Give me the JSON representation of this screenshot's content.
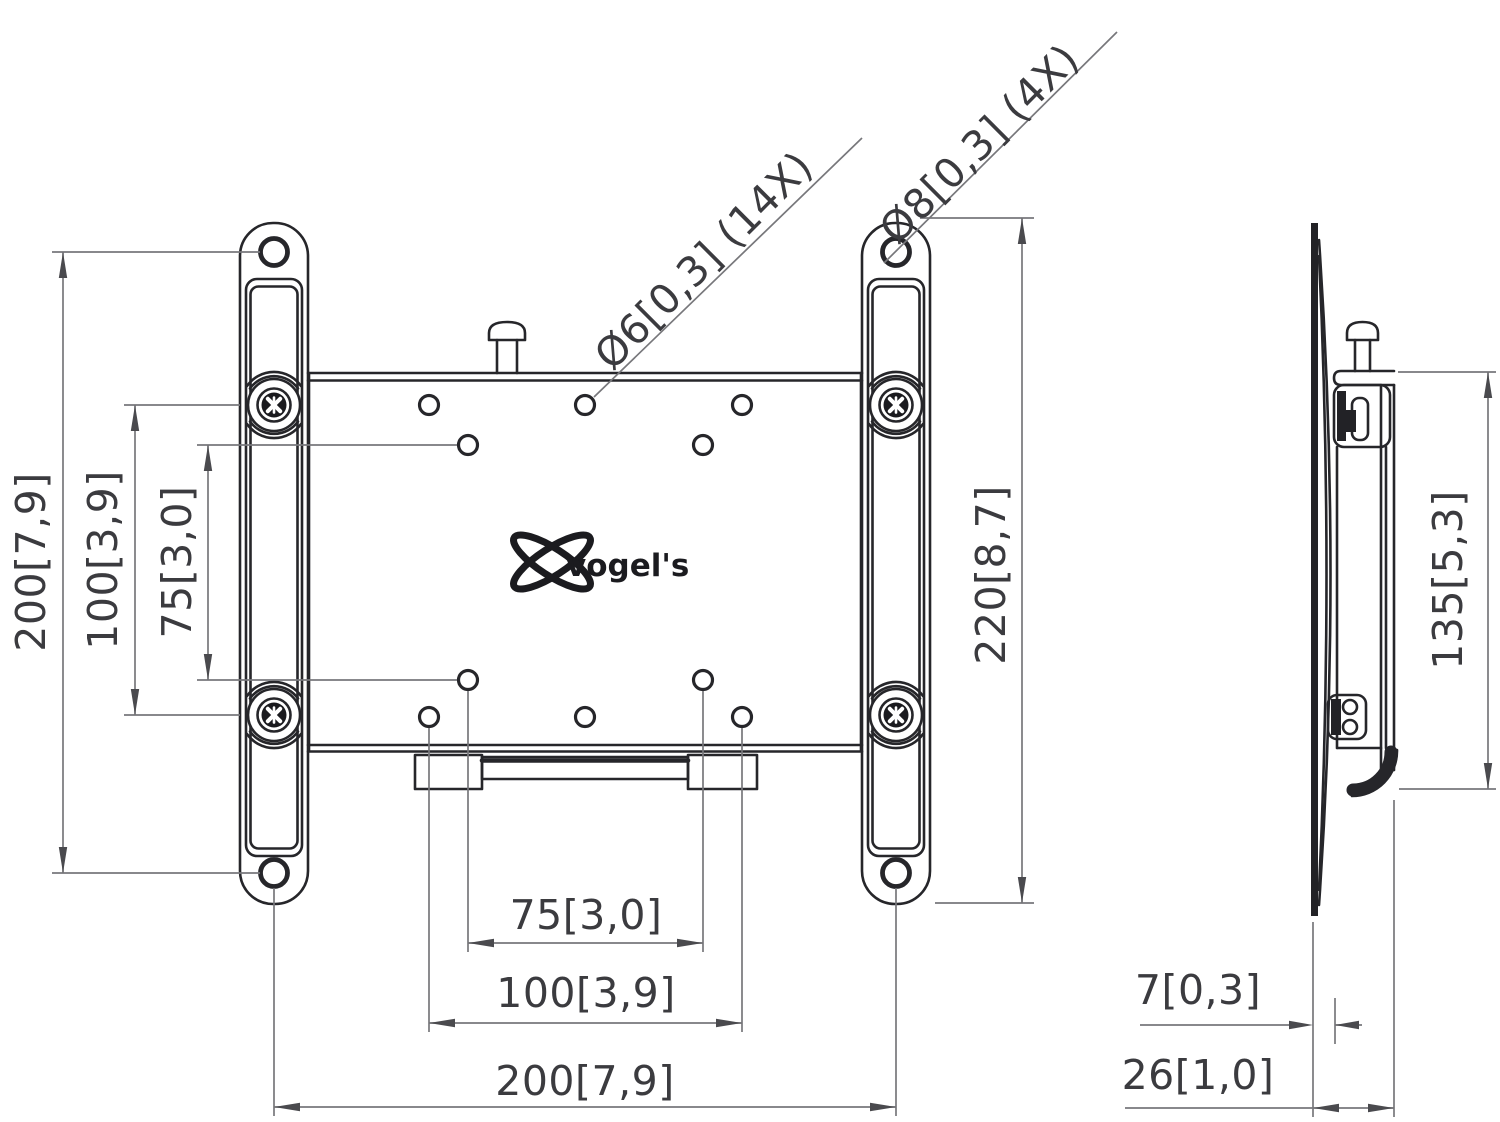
{
  "drawing_type": "technical-dimension-drawing",
  "product": "TV wall mount bracket",
  "views": {
    "front": {
      "dims": {
        "left_outer": "200[7,9]",
        "left_mid": "100[3,9]",
        "left_inner": "75[3,0]",
        "bottom_inner": "75[3,0]",
        "bottom_mid": "100[3,9]",
        "bottom_outer": "200[7,9]",
        "right_height": "220[8,7]"
      },
      "callouts": {
        "plate_holes": "Ø6[0,3] (14X)",
        "strip_holes": "Ø8[0,3] (4X)"
      },
      "logo": "vogel's"
    },
    "side": {
      "dims": {
        "bracket_height": "135[5,3]",
        "plate_thickness": "7[0,3]",
        "total_depth": "26[1,0]"
      }
    }
  },
  "units": "mm [inches]",
  "colors": {
    "background": "#ffffff",
    "object_line": "#26262a",
    "dimension_line": "#77777b",
    "text": "#3b3b3f"
  }
}
